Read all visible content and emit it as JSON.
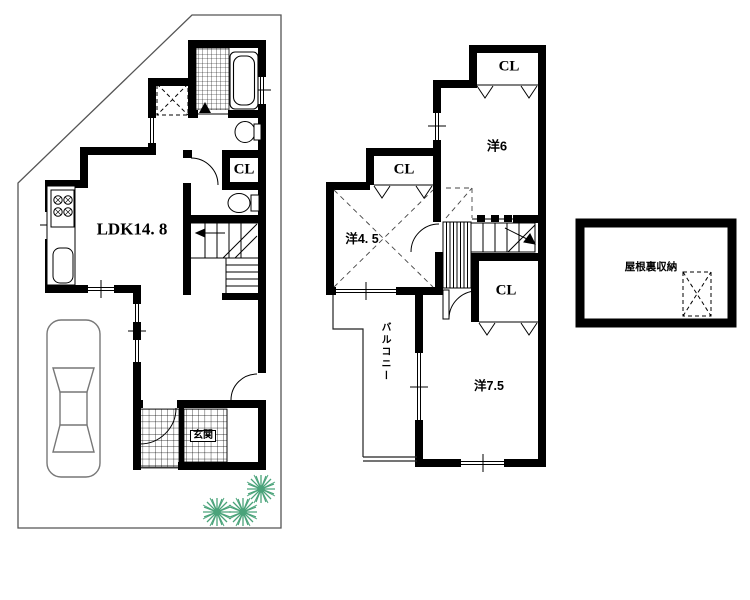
{
  "document": {
    "type": "japanese-house-floor-plan",
    "floors_shown": 2,
    "has_attic_plan": true
  },
  "colors": {
    "wall": "#000000",
    "line": "#222222",
    "site_boundary": "#555555",
    "tree": "#4aa37a",
    "car_outline": "#777777",
    "background": "#ffffff"
  },
  "floor1": {
    "ldk_label": "LDK14. 8",
    "closet_label": "CL",
    "entrance_label": "玄関",
    "fixtures": [
      "bathtub",
      "bathroom-tile-floor",
      "washer-pan",
      "washbasin",
      "toilet",
      "kitchen-stove",
      "kitchen-sink",
      "staircase",
      "entrance-tile-floor",
      "car",
      "garden-trees"
    ]
  },
  "floor2": {
    "room6_label": "洋6",
    "room45_label": "洋4. 5",
    "room75_label": "洋7.5",
    "closet_top_label": "CL",
    "closet_mid_label": "CL",
    "closet_bottom_label": "CL",
    "balcony_label": "バルコニー",
    "fixtures": [
      "staircase-down",
      "closet-fold-door-marks",
      "sloped-ceiling-dashed-x"
    ]
  },
  "attic": {
    "label": "屋根裏収納",
    "fixtures": [
      "ladder-hatch-dashed"
    ]
  }
}
